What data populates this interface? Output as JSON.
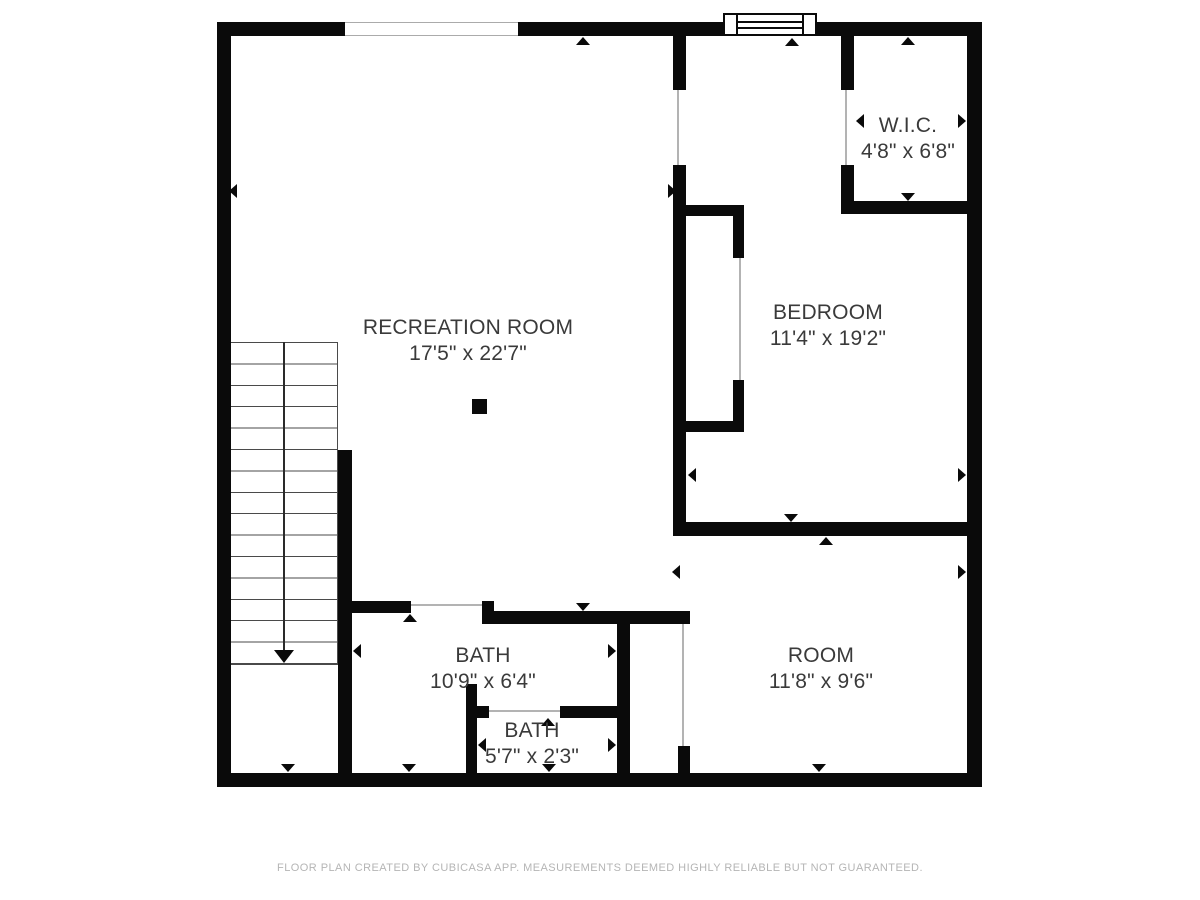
{
  "plan": {
    "type": "floor-plan",
    "rooms": [
      {
        "name": "RECREATION ROOM",
        "dims": "17'5\" x 22'7\""
      },
      {
        "name": "BEDROOM",
        "dims": "11'4\" x 19'2\""
      },
      {
        "name": "W.I.C.",
        "dims": "4'8\" x 6'8\""
      },
      {
        "name": "BATH",
        "dims": "10'9\" x 6'4\""
      },
      {
        "name": "BATH",
        "dims": "5'7\" x 2'3\""
      },
      {
        "name": "ROOM",
        "dims": "11'8\" x 9'6\""
      }
    ],
    "colors": {
      "wall": "#0a0a0a",
      "label_text": "#3a3a3a",
      "opening_line": "#b3b3b3",
      "footer_text": "#b5b5b5",
      "background": "#ffffff"
    }
  },
  "footer": {
    "text": "FLOOR PLAN CREATED BY CUBICASA APP. MEASUREMENTS DEEMED HIGHLY RELIABLE BUT NOT GUARANTEED."
  }
}
